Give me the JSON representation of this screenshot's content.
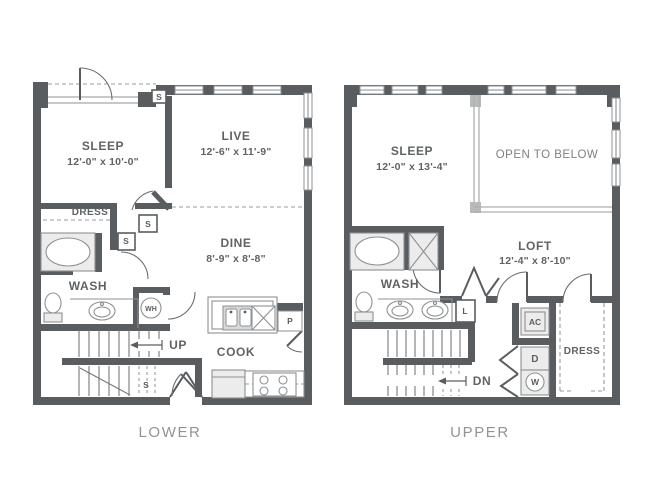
{
  "lower": {
    "caption": "LOWER",
    "sleep_name": "SLEEP",
    "sleep_dims": "12'-0\" x 10'-0\"",
    "live_name": "LIVE",
    "live_dims": "12'-6\" x 11'-9\"",
    "dine_name": "DINE",
    "dine_dims": "8'-9\" x 8'-8\"",
    "cook_name": "COOK",
    "wash_name": "WASH",
    "dress_name": "DRESS",
    "up_label": "UP",
    "wh_label": "WH",
    "pantry_label": "P",
    "s_labels": [
      "S",
      "S",
      "S",
      "S"
    ]
  },
  "upper": {
    "caption": "UPPER",
    "sleep_name": "SLEEP",
    "sleep_dims": "12'-0\" x 13'-4\"",
    "open_below": "OPEN TO BELOW",
    "loft_name": "LOFT",
    "loft_dims": "12'-4\" x 8'-10\"",
    "wash_name": "WASH",
    "dress_name": "DRESS",
    "dn_label": "DN",
    "ac_label": "AC",
    "dryer_label": "D",
    "washer_label": "W",
    "linen_label": "L"
  },
  "colors": {
    "wall_gray": "#5a5d5f",
    "fixture_gray": "#ececec",
    "line_gray": "#8e9193",
    "label_gray": "#606365",
    "caption_gray": "#919396"
  }
}
